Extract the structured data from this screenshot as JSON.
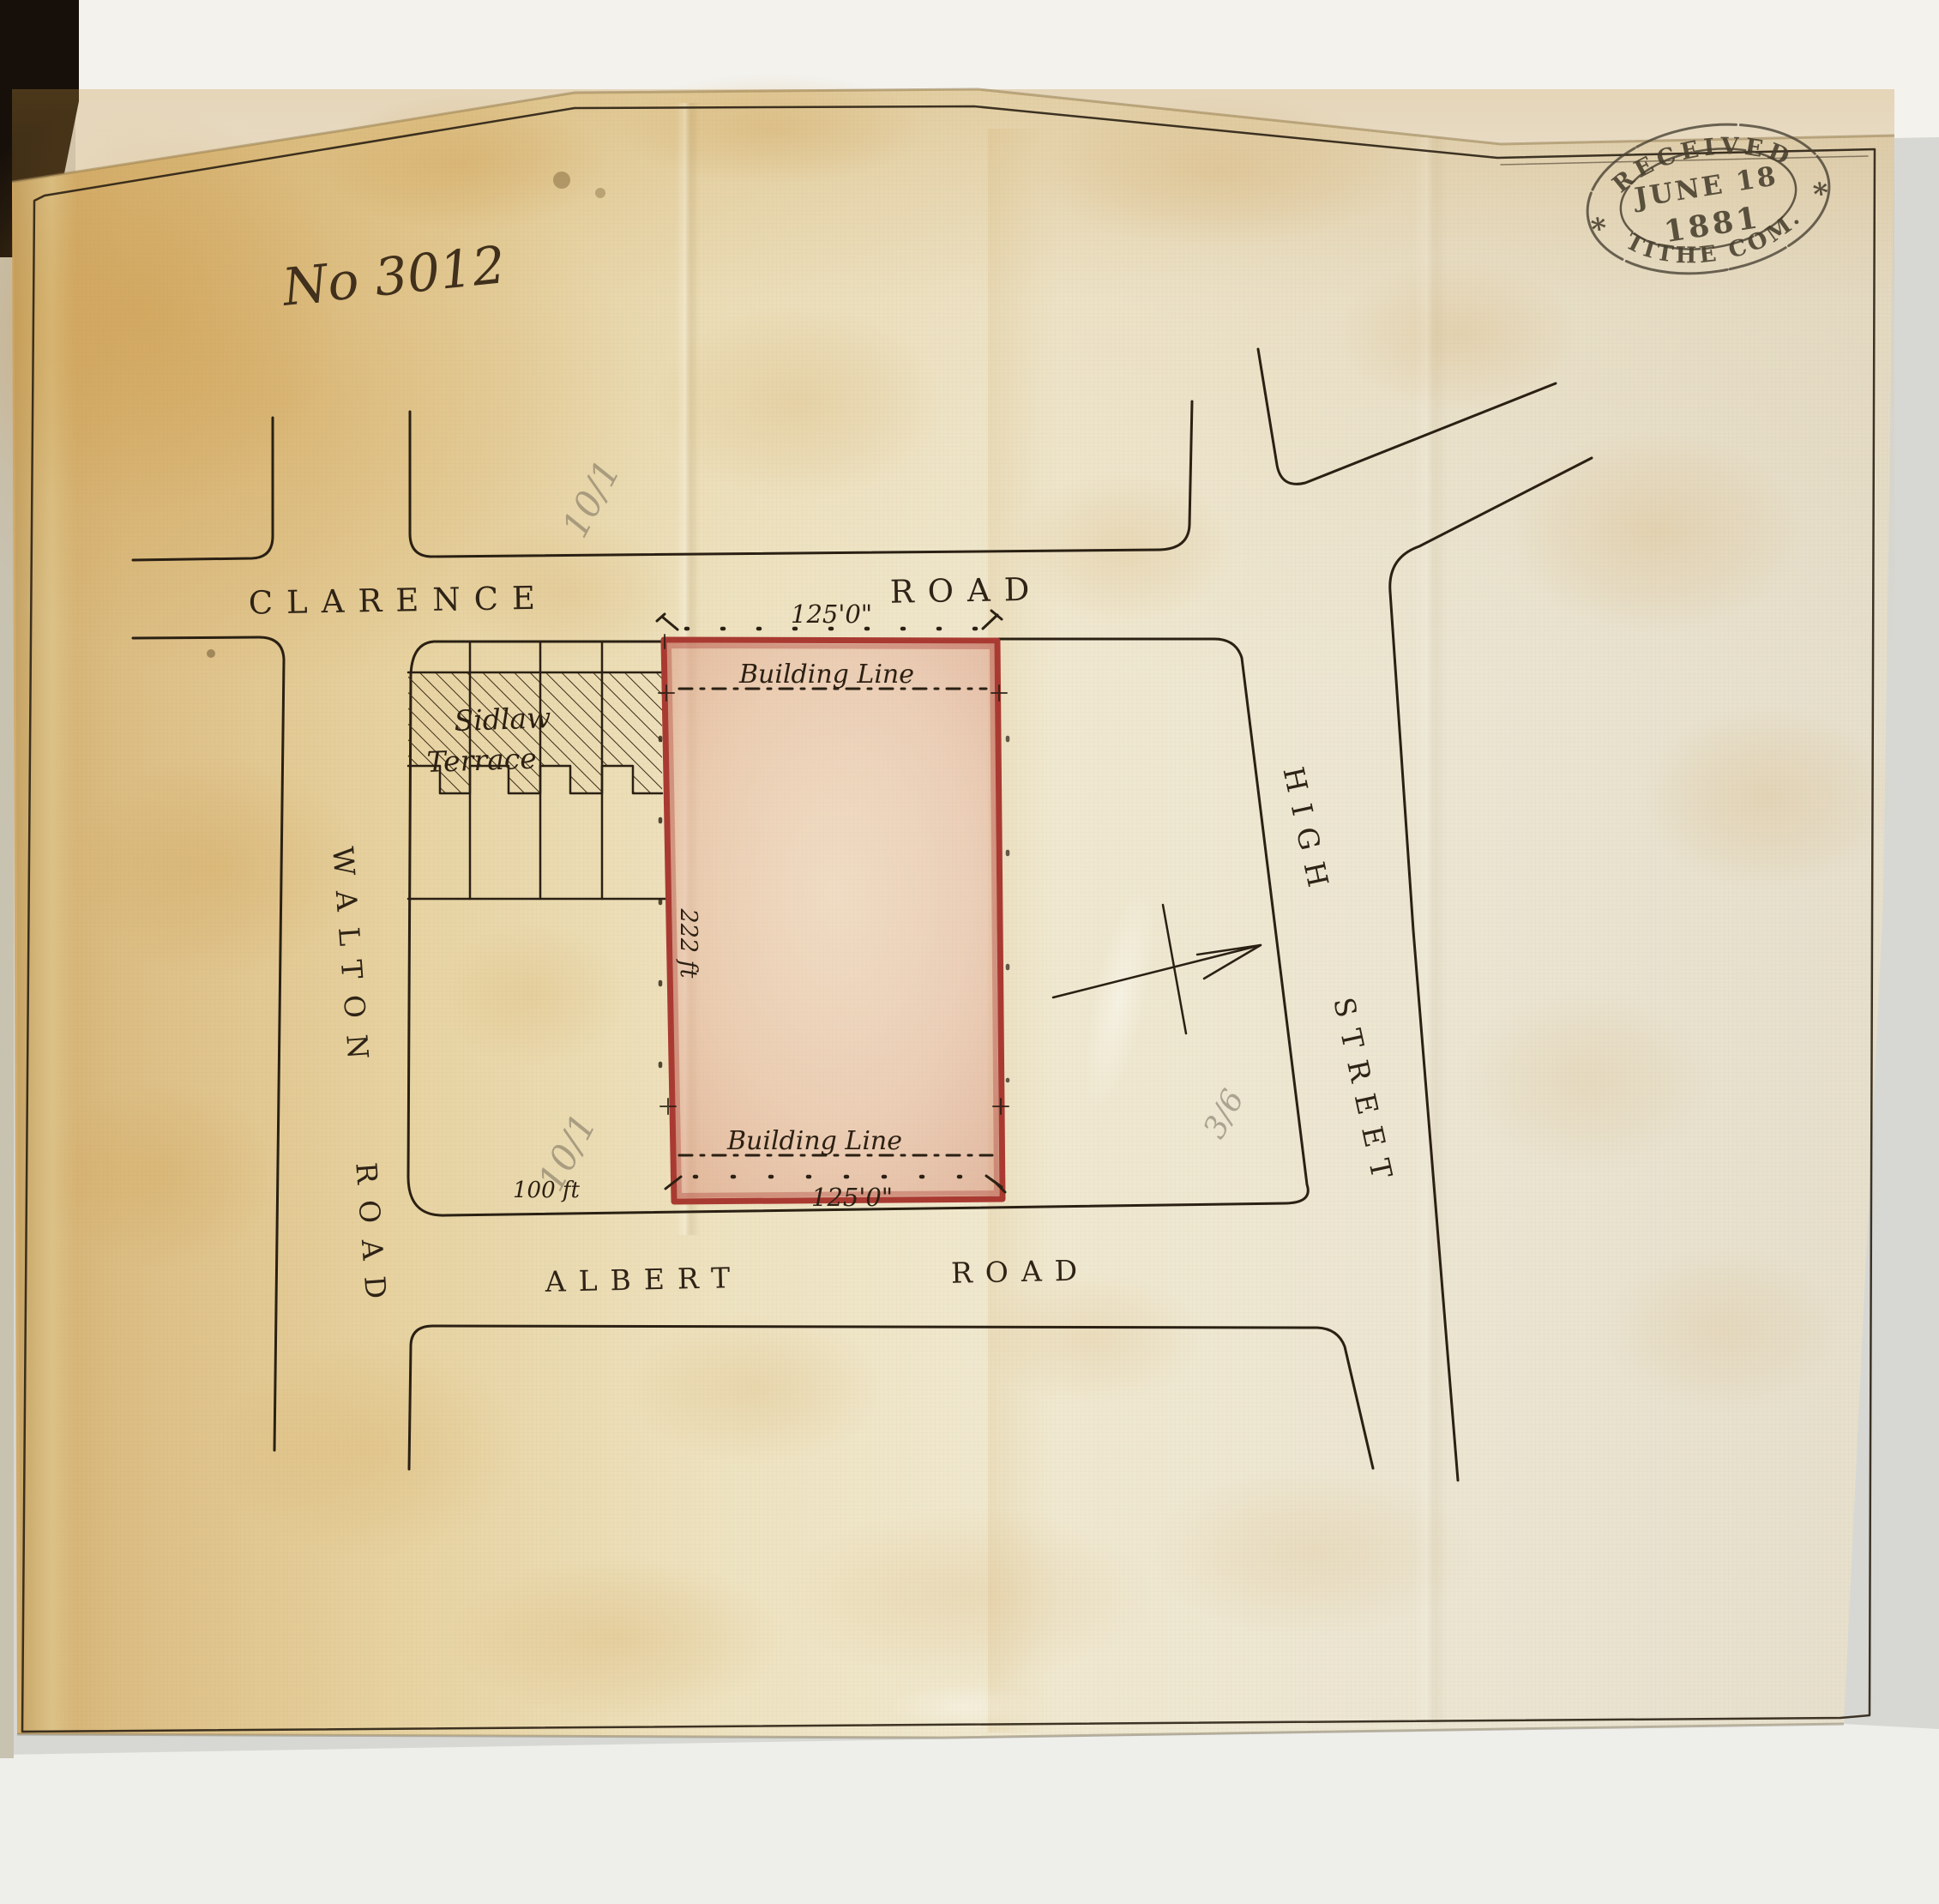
{
  "document": {
    "number": "No 3012",
    "stamp": {
      "top": "RECEIVED",
      "date_line1": "JUNE 18",
      "date_line2": "1881",
      "bottom": "TITHE COM.",
      "star_left": "*",
      "star_right": "*"
    },
    "streets": {
      "clarence": [
        "CLARENCE",
        "ROAD"
      ],
      "walton": [
        "WALTON",
        "ROAD"
      ],
      "high": [
        "HIGH",
        "STREET"
      ],
      "albert": [
        "ALBERT",
        "ROAD"
      ]
    },
    "terrace": {
      "line1": "Sidlaw",
      "line2": "Terrace"
    },
    "plot": {
      "building_line_top": "Building Line",
      "building_line_bottom": "Building Line",
      "width_top": "125'0\"",
      "width_bottom": "125'0\"",
      "depth": "222 ft",
      "frontage_offset": "100 ft"
    },
    "pencil_notes": [
      "10/1",
      "10/1",
      "3/6"
    ],
    "colors": {
      "plot_outline": "#a93a32",
      "plot_wash": "#e2ab97",
      "ink": "#2a2013",
      "stamp_ink": "#473e2d",
      "cloth": "#e9dcb4"
    }
  }
}
